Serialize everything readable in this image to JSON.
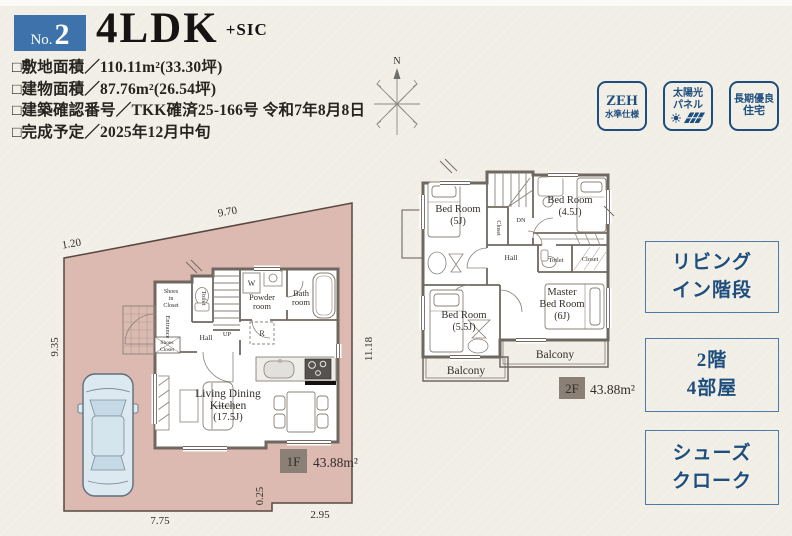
{
  "header": {
    "no_label": "No.",
    "no_value": "2",
    "title": "4LDK",
    "suffix": "+SIC"
  },
  "details": {
    "lines": [
      "□敷地面積／110.11m²(33.30坪)",
      "□建物面積／87.76m²(26.54坪)",
      "□建築確認番号／TKK確済25-166号 令和7年8月8日",
      "□完成予定／2025年12月中旬"
    ]
  },
  "stamps": [
    {
      "line1": "ZEH",
      "line2": "水準仕様"
    },
    {
      "line1": "太陽光",
      "line2": "パネル"
    },
    {
      "line1": "長期優良",
      "line2": "住宅"
    }
  ],
  "features": [
    {
      "line1": "リビング",
      "line2": "イン階段"
    },
    {
      "line1": "2階",
      "line2": "4部屋"
    },
    {
      "line1": "シューズ",
      "line2": "クローク"
    }
  ],
  "compass": {
    "north": "N"
  },
  "floor1": {
    "badge": "1F",
    "area": "43.88m²",
    "rooms": {
      "ldk1": "Living Dining",
      "ldk2": "Kitchen",
      "ldk3": "(17.5J)",
      "powder1": "Powder",
      "powder2": "room",
      "bath1": "Bath",
      "bath2": "room",
      "toilet": "Toilet",
      "hall": "Hall",
      "up": "UP",
      "washer": "W",
      "fridge": "R",
      "entrance": "Entrance",
      "sic1": "Shoes",
      "sic2": "in",
      "sic3": "Closet",
      "shoes1": "Shoes",
      "shoes2": "Closet"
    },
    "dims": {
      "top": "9.70",
      "top_left": "1.20",
      "left": "9.35",
      "right": "11.18",
      "bottom_left": "7.75",
      "step": "0.25",
      "bottom_right": "2.95"
    }
  },
  "floor2": {
    "badge": "2F",
    "area": "43.88m²",
    "rooms": {
      "bed5_1": "Bed Room",
      "bed5_2": "(5J)",
      "bed45_1": "Bed Room",
      "bed45_2": "(4.5J)",
      "bed55_1": "Bed Room",
      "bed55_2": "(5.5J)",
      "master1": "Master",
      "master2": "Bed Room",
      "master3": "(6J)",
      "closet_a": "Closet",
      "closet_b": "Closet",
      "toilet": "Toilet",
      "hall": "Hall",
      "dn": "DN",
      "balcony_a": "Balcony",
      "balcony_b": "Balcony"
    }
  },
  "colors": {
    "accent_blue": "#3d72ab",
    "stamp_navy": "#1d4e7e",
    "plot_pink": "#dcb9b1",
    "wall_gray": "#6f6861",
    "badge_gray": "#8a8076",
    "feature_border": "#4e79a8"
  }
}
